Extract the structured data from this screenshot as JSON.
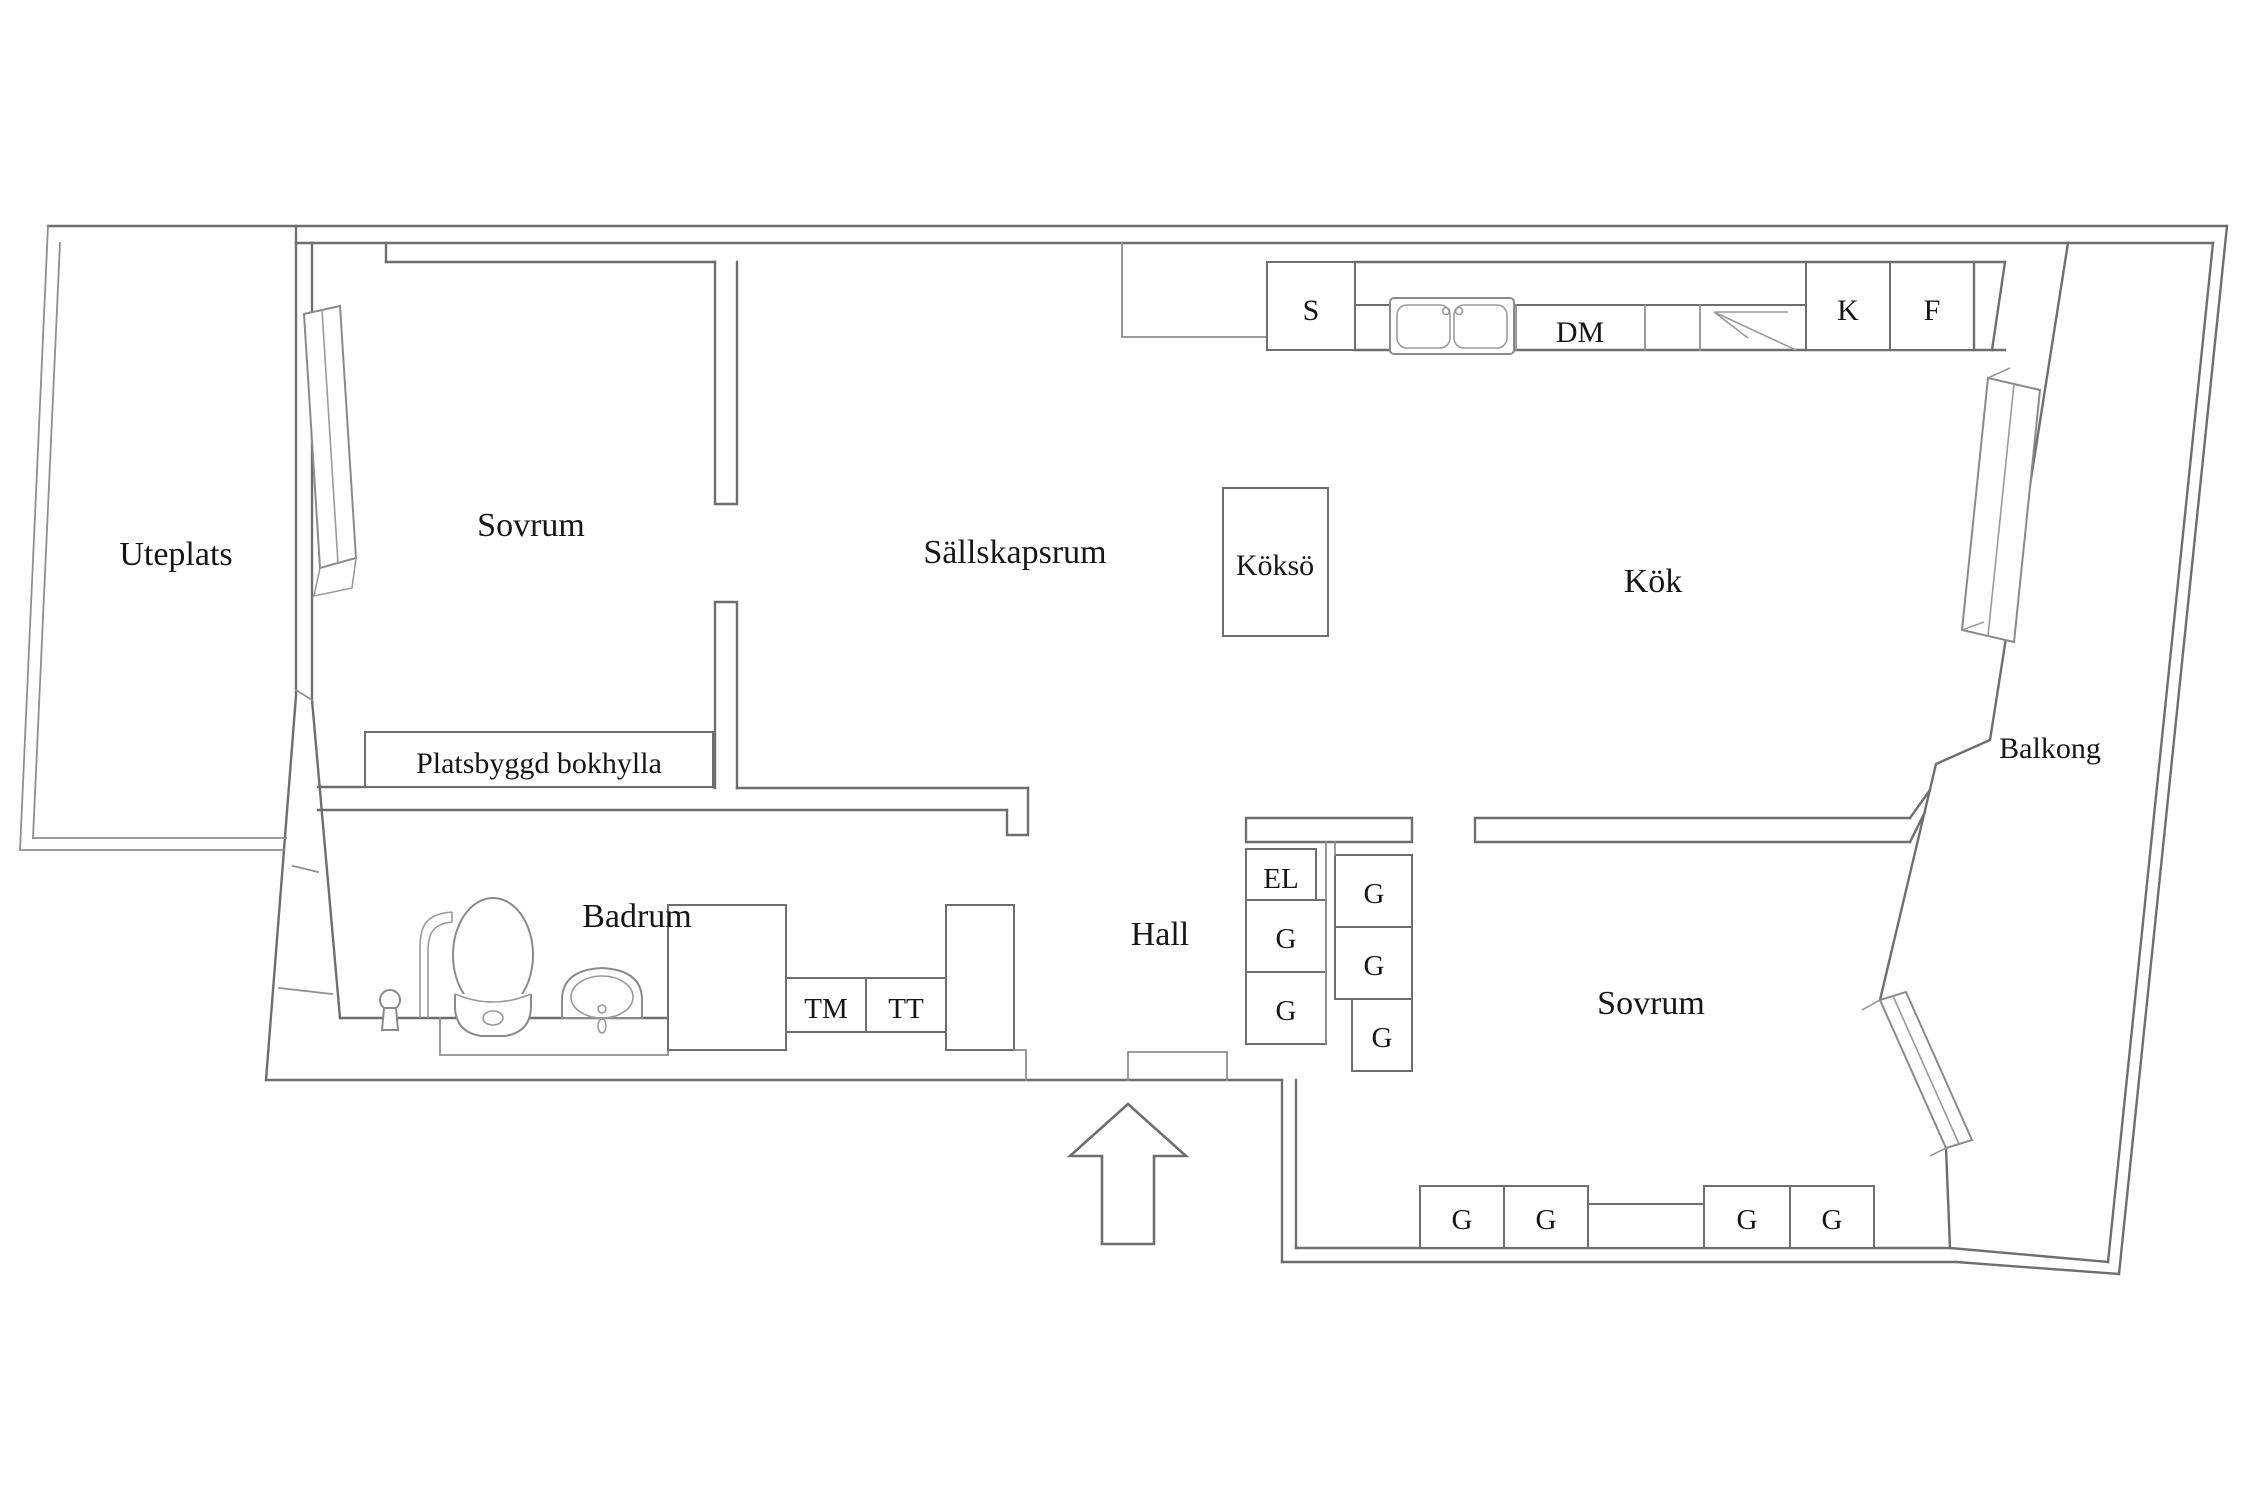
{
  "plan_type": "apartment-floor-plan",
  "language": "sv",
  "colors": {
    "background": "#ffffff",
    "wall_line": "#6e6e6e",
    "thin_line": "#8f8f8f",
    "text": "#161616"
  },
  "rooms": {
    "uteplats": "Uteplats",
    "sovrum_left": "Sovrum",
    "sallskapsrum": "Sällskapsrum",
    "kok": "Kök",
    "kokso": "Köksö",
    "balkong": "Balkong",
    "badrum": "Badrum",
    "hall": "Hall",
    "sovrum_right": "Sovrum"
  },
  "fixtures": {
    "bookshelf": "Platsbyggd bokhylla",
    "kitchen_units": {
      "s": "S",
      "dm": "DM",
      "k": "K",
      "f": "F"
    },
    "laundry": {
      "tm": "TM",
      "tt": "TT"
    },
    "electrical": "EL"
  },
  "wardrobes": [
    "G",
    "G",
    "G",
    "G",
    "G",
    "G",
    "G",
    "G",
    "G"
  ],
  "icons": [
    "kitchen-sink",
    "corner-cabinet",
    "toilet",
    "washbasin",
    "shower",
    "floor-drain",
    "window",
    "balcony-door",
    "entrance-arrow"
  ]
}
